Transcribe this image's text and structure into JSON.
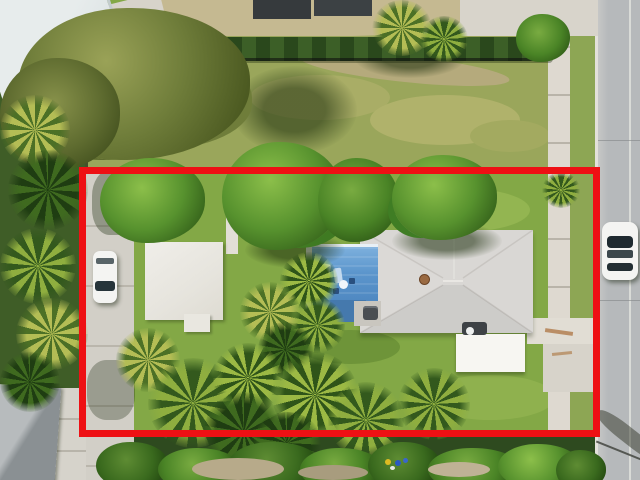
{
  "image": {
    "kind": "aerial drone photograph",
    "subject": "single-family residential lot outlined in red",
    "width_px": 640,
    "height_px": 480
  },
  "palette": {
    "boundary_red": "#ee1014",
    "lawn_green": "#83a846",
    "vacant_grass": "#9aa65b",
    "road_gray": "#b6b9bb",
    "sidewalk_concrete": "#ded9d0",
    "driveway_concrete": "#d2cfc7",
    "pool_deck_blue": "#5b95cc",
    "main_roof_gray": "#d9d7d4",
    "flat_roof_white": "#edebe5",
    "shed_white": "#f7f6f2",
    "hedge_green": "#2d4b1d",
    "canopy_green": "#57922e",
    "palm_yellow_green": "#b4bd55",
    "dark_roof": "#363a3d",
    "car_white": "#f4f4f2"
  },
  "scene": {
    "overlay": {
      "label": "red property-boundary outline",
      "color": "#ee1014"
    },
    "buildings": [
      "main house with light gray hip roof",
      "white flat-roof guest building",
      "white storage shed",
      "neighboring dark-roof building at top",
      "neighboring gable-roof house at bottom left"
    ],
    "features": [
      "blue tiled pool deck with patio furniture",
      "concrete alley driveway on west side of lot",
      "public sidewalk and street along east side",
      "vacant grass lot to the north behind a hedge row",
      "dense palm and tropical vegetation along south edge",
      "small colorful objects (toys/buckets) in south vegetation"
    ],
    "vehicles": [
      "white car parked in alley driveway",
      "white car parked on lawn near north boundary",
      "white car parked on street at east boundary"
    ]
  }
}
